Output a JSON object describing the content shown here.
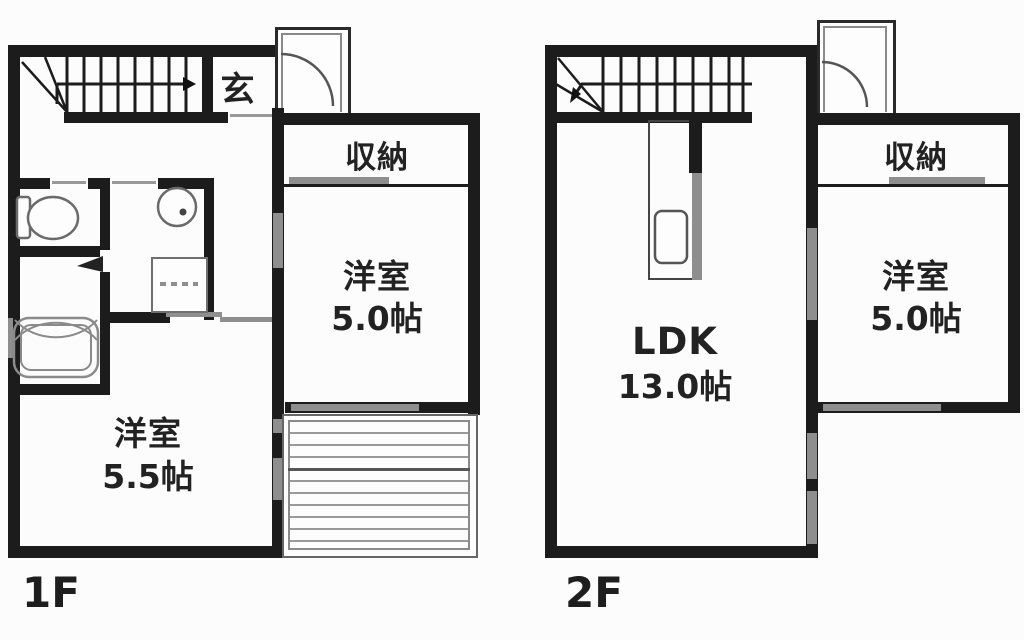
{
  "diagram": {
    "type": "floor-plan",
    "background": "#fcfcfc",
    "wall_color": "#1c1c1c",
    "accent_gray": "#8e8e8e"
  },
  "floors": [
    {
      "label": "1F",
      "rooms": [
        {
          "name": "genkan",
          "label": "玄"
        },
        {
          "name": "closet",
          "label": "収納"
        },
        {
          "name": "western-room-a",
          "label": "洋室",
          "size": "5.0帖"
        },
        {
          "name": "western-room-b",
          "label": "洋室",
          "size": "5.5帖"
        }
      ],
      "fixtures": {
        "stairs": "staircase-up-icon",
        "entrance": "entrance-door-icon",
        "toilet": "toilet-icon",
        "basin": "washbasin-icon",
        "washer": "washing-machine-pan-icon",
        "bathtub": "bathtub-icon",
        "deck": "deck-boards-icon"
      }
    },
    {
      "label": "2F",
      "rooms": [
        {
          "name": "ldk",
          "label": "LDK",
          "size": "13.0帖"
        },
        {
          "name": "closet",
          "label": "収納"
        },
        {
          "name": "western-room",
          "label": "洋室",
          "size": "5.0帖"
        }
      ],
      "fixtures": {
        "stairs": "staircase-down-icon",
        "door": "balcony-door-icon",
        "kitchen": "kitchen-sink-icon"
      }
    }
  ]
}
